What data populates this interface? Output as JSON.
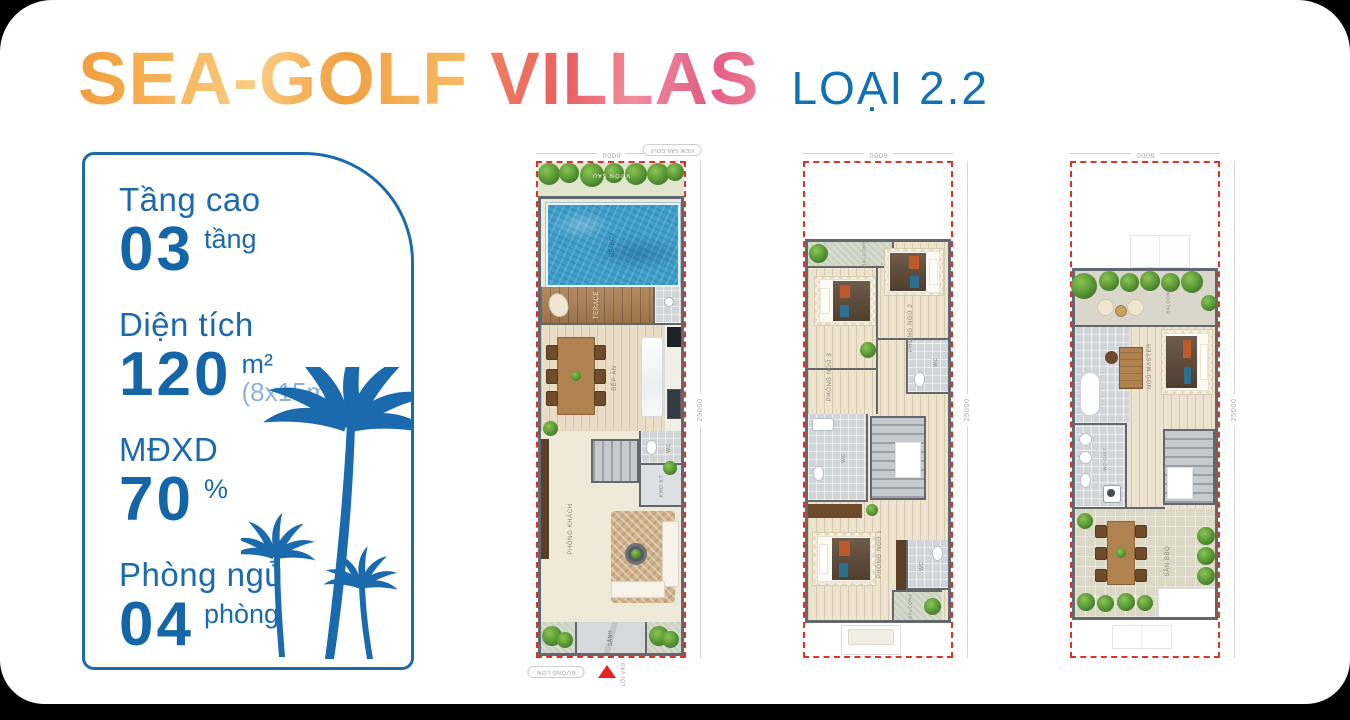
{
  "header": {
    "title_primary": "SEA-GOLF",
    "title_secondary": "VILLAS",
    "variant": "LOẠI 2.2"
  },
  "specs": {
    "items": [
      {
        "label": "Tầng cao",
        "value": "03",
        "unit": "tầng"
      },
      {
        "label": "Diện tích",
        "value": "120",
        "unit": "m²",
        "note": "(8x15m)"
      },
      {
        "label": "MĐXD",
        "value": "70",
        "unit": "%"
      },
      {
        "label": "Phòng ngủ",
        "value": "04",
        "unit": "phòng"
      }
    ]
  },
  "plans": [
    {
      "dims": {
        "width": "6000",
        "depth": "25000"
      },
      "labels": {
        "view_tag": "VIEW SÂN GOLF",
        "garden": "VƯỜN SAU",
        "pool": "BỂ BƠI",
        "terrace": "TERACE",
        "kitchen": "BẾP ĂN",
        "wc": "WC",
        "storage": "KHO KT",
        "living": "PHÒNG KHÁCH",
        "lobby": "SẢNH",
        "entry": "LỐI VÀO",
        "road": "ĐƯỜNG LỚN"
      }
    },
    {
      "dims": {
        "width": "6000",
        "depth": "25000"
      },
      "labels": {
        "balcony_front": "BALCONY",
        "bedroom2": "PHÒNG NGỦ 2",
        "bedroom3": "PHÒNG NGỦ 3",
        "wc_front": "WC",
        "wc_mid": "WC",
        "bedroom1": "PHÒNG NGỦ 1",
        "wc_rear": "WC",
        "balcony_rear": "BALCONY"
      }
    },
    {
      "dims": {
        "width": "6000",
        "depth": "25000"
      },
      "labels": {
        "balcony": "BALCONY",
        "master_bedroom": "NGỦ MASTER",
        "wc_laundry": "WC GIẶT",
        "bbq": "SÂN BBQ"
      }
    }
  ],
  "colors": {
    "accent_blue": "#1a6aad",
    "title_orange": "#f3a44a",
    "title_pink": "#ec6375",
    "variant_blue": "#1271b5",
    "dashed_red": "#dd3327",
    "pool_blue": "#3e9ec9"
  }
}
